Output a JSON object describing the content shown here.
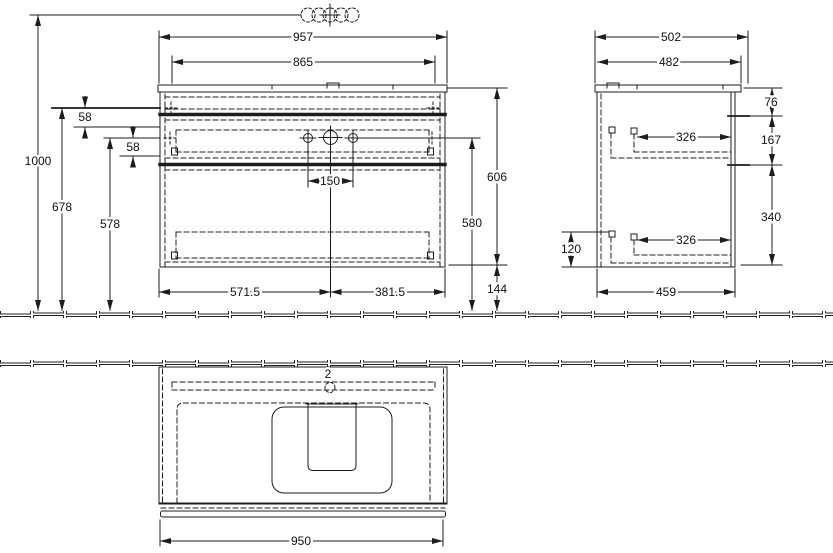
{
  "front": {
    "width_total": "957",
    "width_inner": "865",
    "height_total": "1000",
    "height_top_rail": "678",
    "height_holes_rail": "578",
    "rail_offset_top": "58",
    "rail_offset_bottom": "58",
    "hole_spacing": "150",
    "height_body": "606",
    "height_holes": "580",
    "height_clearance": "144",
    "span_left": "571.5",
    "span_right": "381.5"
  },
  "side": {
    "depth_total": "502",
    "depth_top": "482",
    "offset_top": "76",
    "drawer_gap": "167",
    "drawer_depth_upper": "326",
    "drawer_depth_lower": "326",
    "height_lower": "340",
    "height_plinth_rail": "120",
    "depth_body": "459"
  },
  "plan": {
    "hole_count": "2",
    "width_basin": "950"
  }
}
